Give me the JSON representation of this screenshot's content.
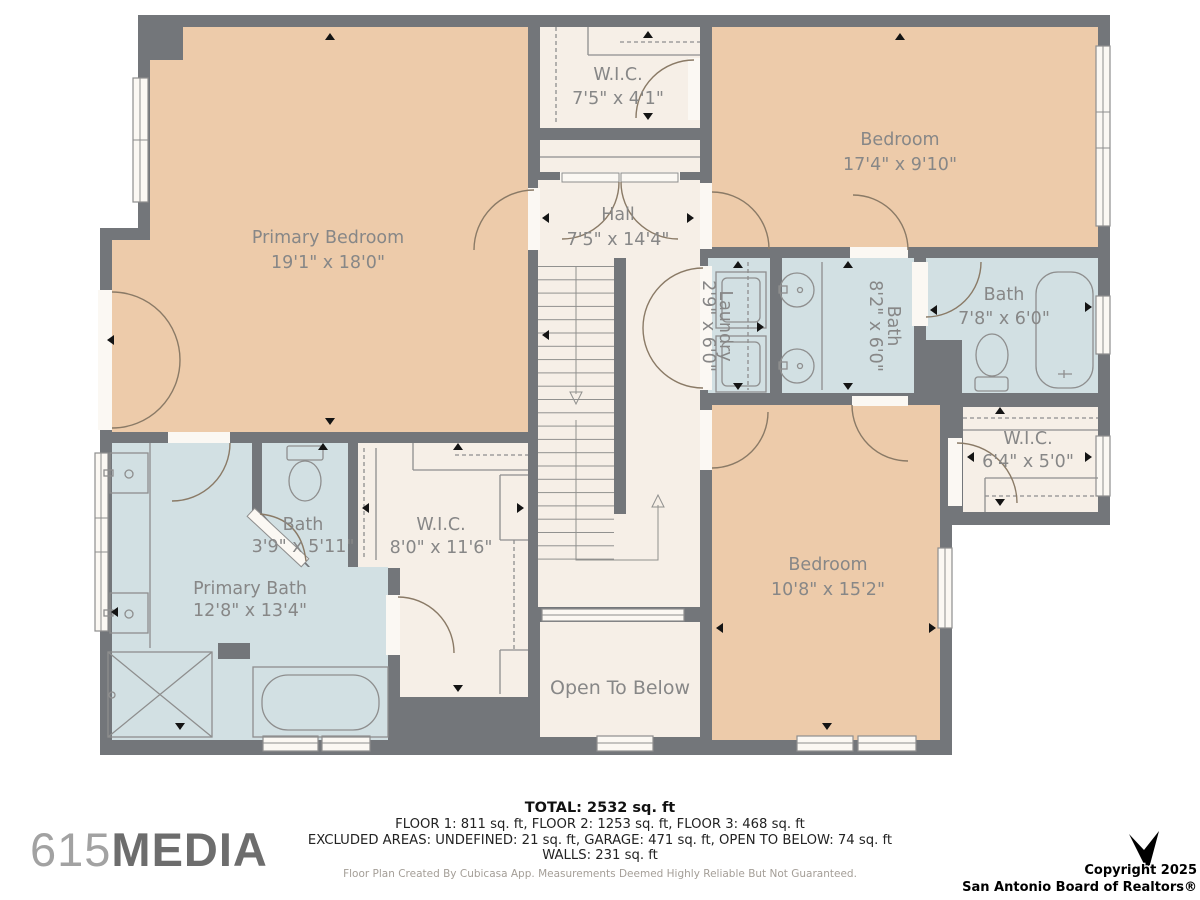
{
  "plan": {
    "colors": {
      "wall": "#73767a",
      "peach": "#edcbaa",
      "cream": "#f6efe7",
      "blue": "#d2e0e3",
      "white": "#fbf8f3",
      "line": "#8e8e8e",
      "door": "#8a7a66",
      "label": "#878787"
    },
    "rooms": {
      "primary_bedroom": {
        "name": "Primary Bedroom",
        "dims": "19'1\" x 18'0\""
      },
      "wic_top": {
        "name": "W.I.C.",
        "dims": "7'5\" x 4'1\""
      },
      "hall": {
        "name": "Hall",
        "dims": "7'5\" x 14'4\""
      },
      "bedroom_top": {
        "name": "Bedroom",
        "dims": "17'4\" x 9'10\""
      },
      "laundry": {
        "name": "Laundry",
        "dims": "2'9\" x 6'0\""
      },
      "bath_center": {
        "name": "Bath",
        "dims": "8'2\" x 6'0\""
      },
      "bath_right": {
        "name": "Bath",
        "dims": "7'8\" x 6'0\""
      },
      "wic_right": {
        "name": "W.I.C.",
        "dims": "6'4\" x 5'0\""
      },
      "bedroom_bottom": {
        "name": "Bedroom",
        "dims": "10'8\" x 15'2\""
      },
      "bath_small": {
        "name": "Bath",
        "dims": "3'9\" x 5'11\""
      },
      "wic_left": {
        "name": "W.I.C.",
        "dims": "8'0\" x 11'6\""
      },
      "primary_bath": {
        "name": "Primary Bath",
        "dims": "12'8\" x 13'4\""
      },
      "open_to_below": {
        "name": "Open To Below"
      }
    }
  },
  "footer": {
    "total": "TOTAL: 2532 sq. ft",
    "floors": "FLOOR 1: 811 sq. ft, FLOOR 2: 1253 sq. ft, FLOOR 3: 468 sq. ft",
    "excluded": "EXCLUDED AREAS: UNDEFINED: 21 sq. ft, GARAGE: 471 sq. ft, OPEN TO BELOW: 74 sq. ft",
    "walls": "WALLS: 231 sq. ft",
    "disclaimer": "Floor Plan Created By Cubicasa App. Measurements Deemed Highly Reliable But Not Guaranteed."
  },
  "branding": {
    "logo_prefix": "615",
    "logo_suffix": "MEDIA"
  },
  "copyright": {
    "line1": "Copyright 2025",
    "line2": "San Antonio Board of Realtors®"
  }
}
